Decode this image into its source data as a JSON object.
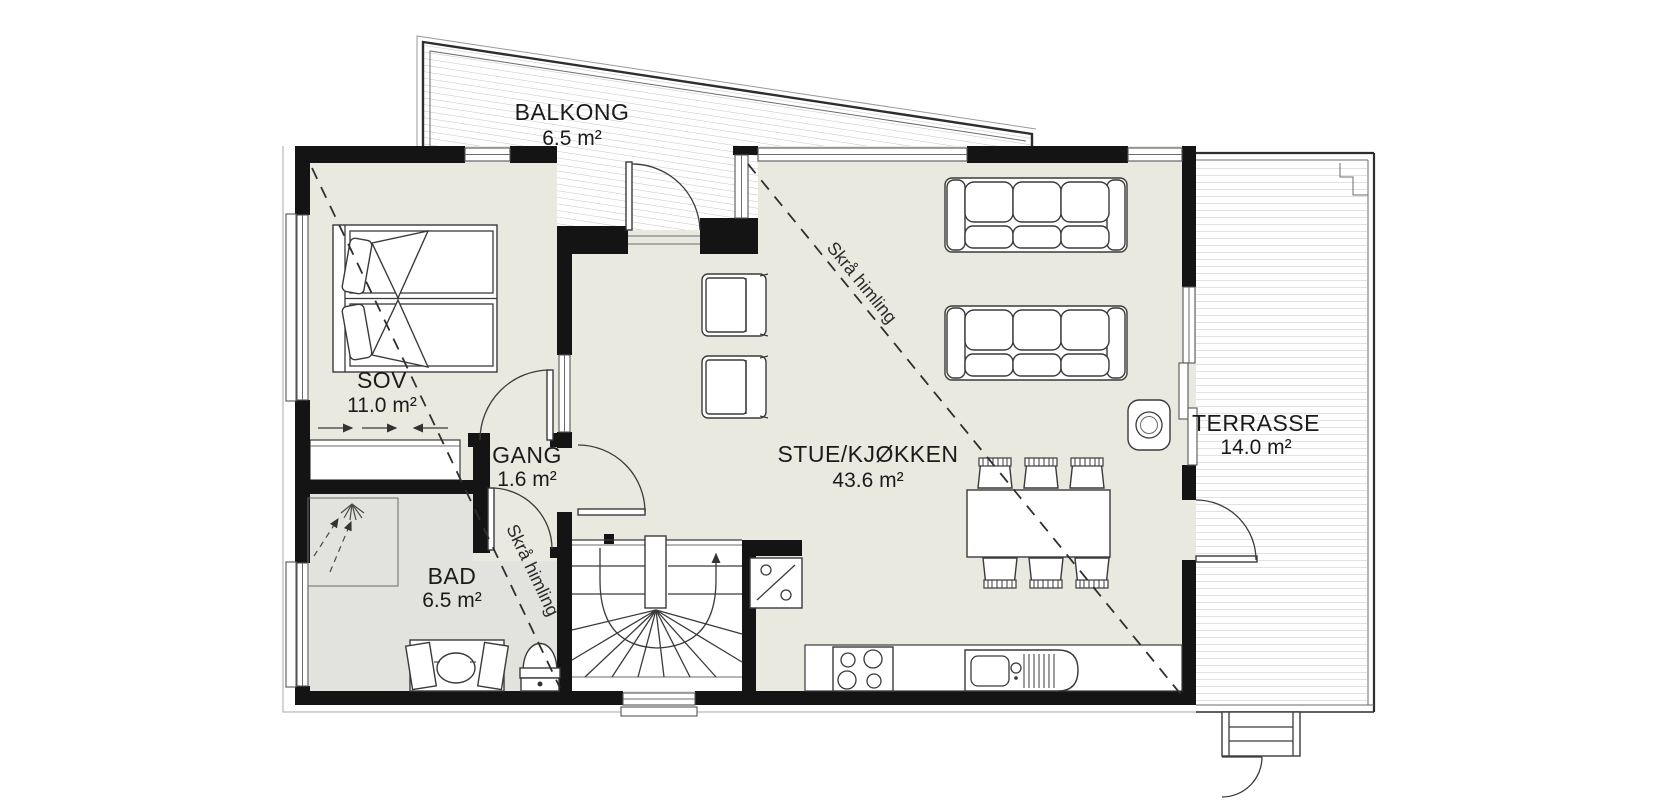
{
  "plan": {
    "rooms": [
      {
        "id": "balkong",
        "name": "BALKONG",
        "area": "6.5 m²"
      },
      {
        "id": "sov",
        "name": "SOV",
        "area": "11.0 m²"
      },
      {
        "id": "gang",
        "name": "GANG",
        "area": "1.6 m²"
      },
      {
        "id": "bad",
        "name": "BAD",
        "area": "6.5 m²"
      },
      {
        "id": "stue-kjokken",
        "name": "STUE/KJØKKEN",
        "area": "43.6 m²"
      },
      {
        "id": "terrasse",
        "name": "TERRASSE",
        "area": "14.0 m²"
      }
    ],
    "annotations": [
      {
        "id": "skra-himling-stue",
        "text": "Skrå himling"
      },
      {
        "id": "skra-himling-sov",
        "text": "Skrå himling"
      }
    ],
    "colors": {
      "wall": "#141414",
      "floor": "#eae9e0",
      "bathroom_floor": "#e2e2df",
      "deck_line": "#c4c4c4",
      "line": "#3a3a3a",
      "background": "#ffffff"
    }
  }
}
